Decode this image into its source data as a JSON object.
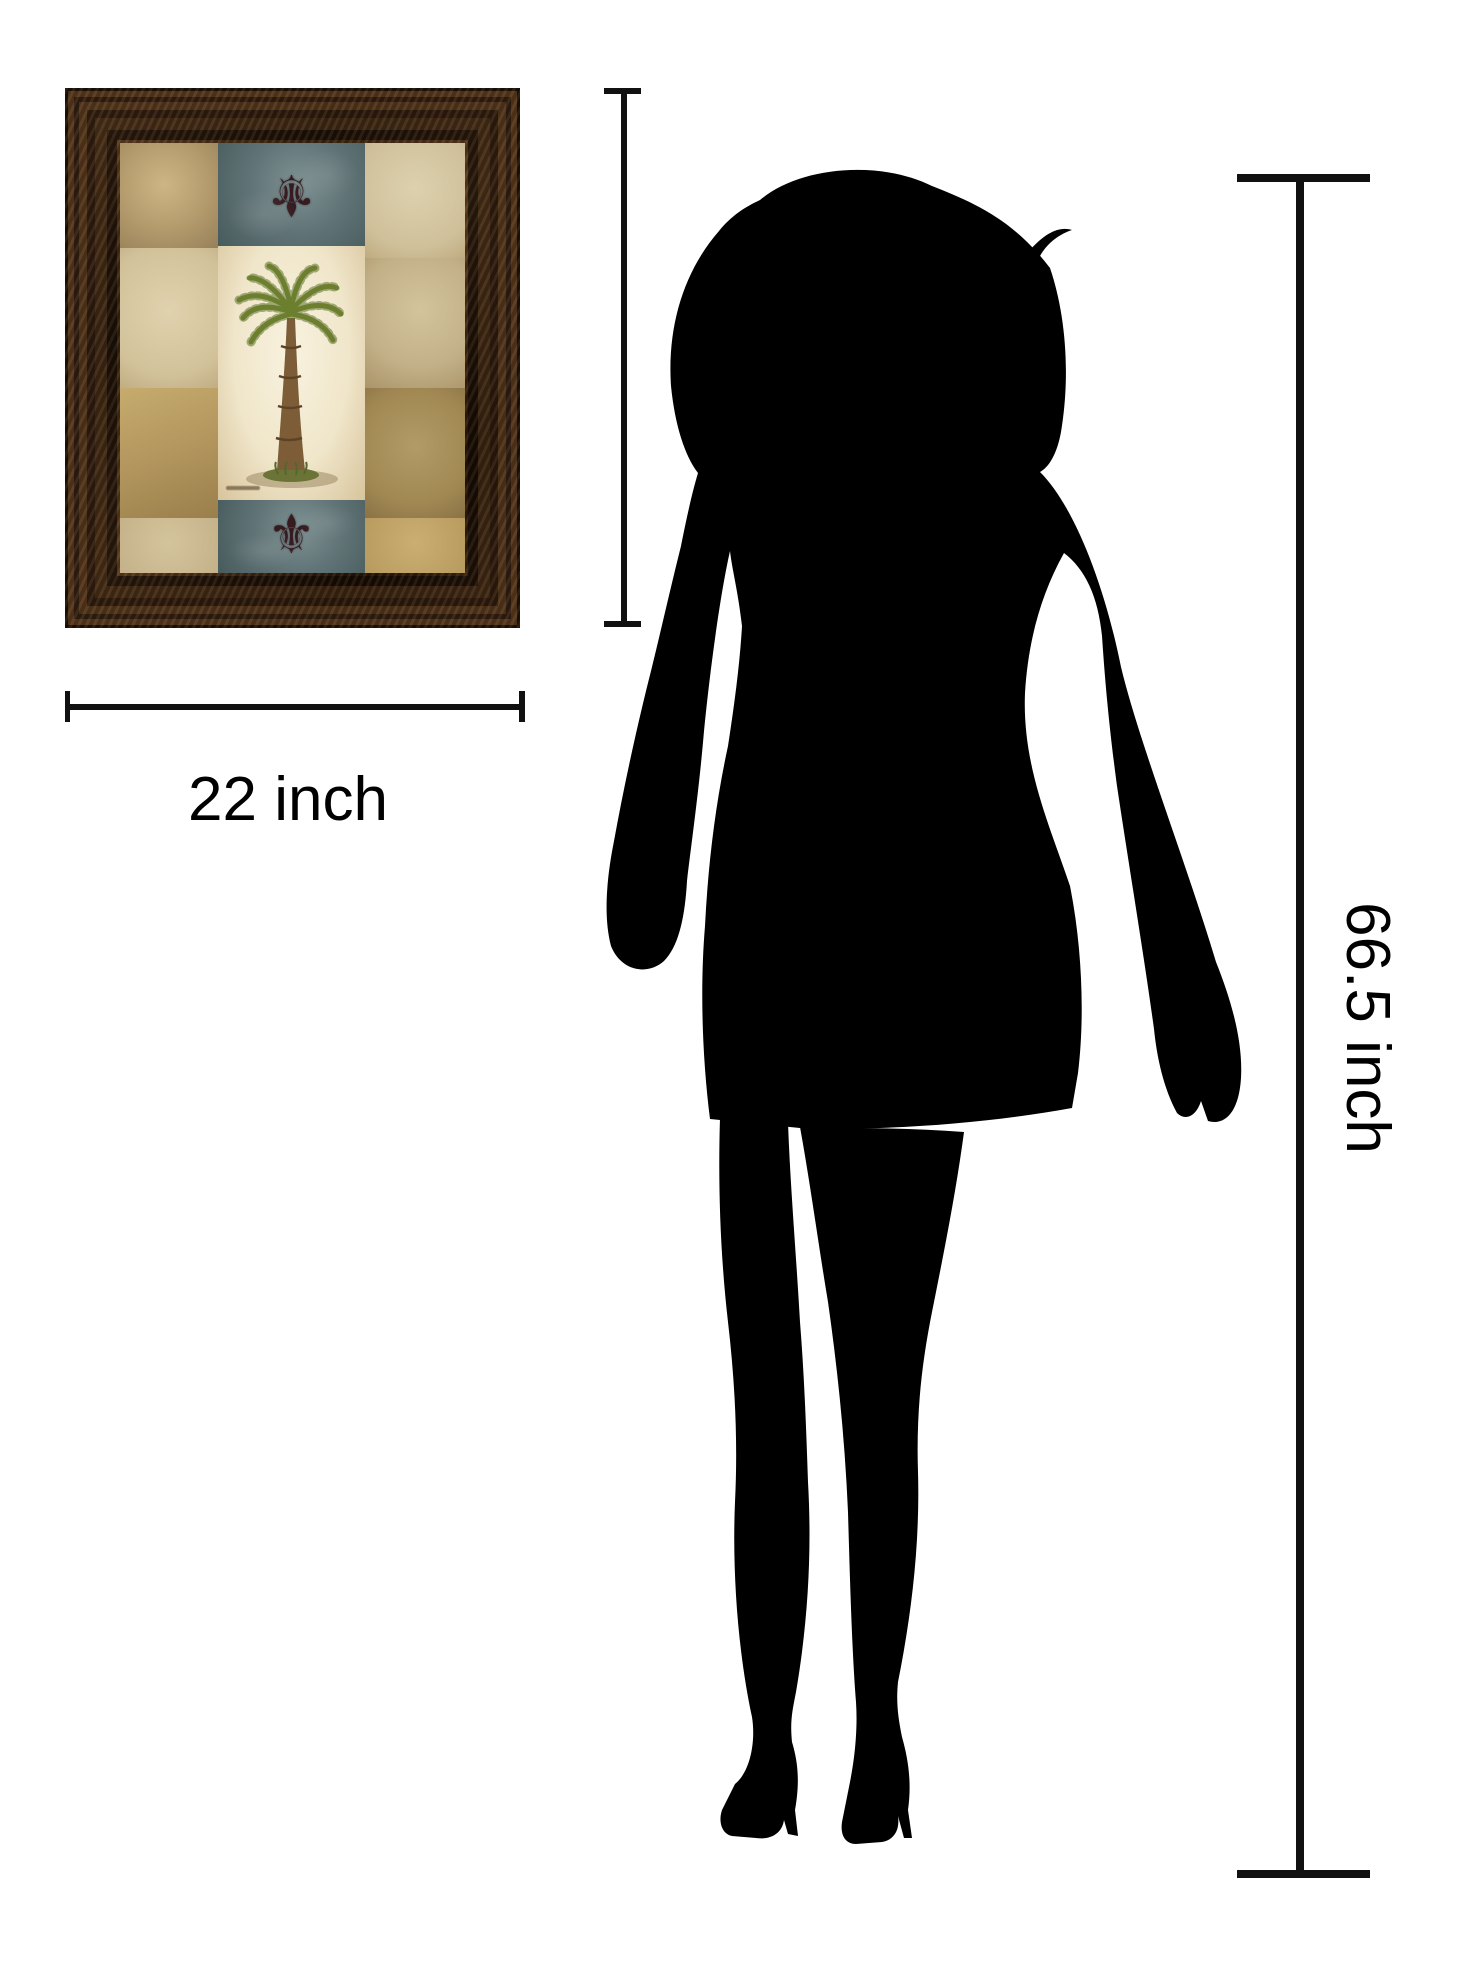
{
  "canvas": {
    "width": 1463,
    "height": 1975,
    "background": "#ffffff"
  },
  "artwork": {
    "description": "Framed palm tree patchwork wall art with fleur-de-lis and damask panels",
    "frame_style": "ornate bronze molding",
    "fleur_glyph": "⚜",
    "icons": [
      "palm-tree-icon",
      "fleur-de-lis-icon"
    ]
  },
  "measurements": {
    "artwork_height": {
      "label": "26 inch"
    },
    "artwork_width": {
      "label": "22 inch"
    },
    "person_height": {
      "label": "66.5 inch"
    }
  },
  "silhouette": {
    "description": "standing woman silhouette",
    "color": "#000000"
  },
  "colors": {
    "dimension_line": "#111111",
    "label_text": "#000000",
    "frame_dark": "#2e1a0c",
    "frame_light": "#7a4f28",
    "slate_panel": "#66797b",
    "cream_panel": "#efe7d0",
    "fleur": "#361c20",
    "palm_green": "#7a8f35",
    "trunk_brown": "#7d5d38"
  }
}
